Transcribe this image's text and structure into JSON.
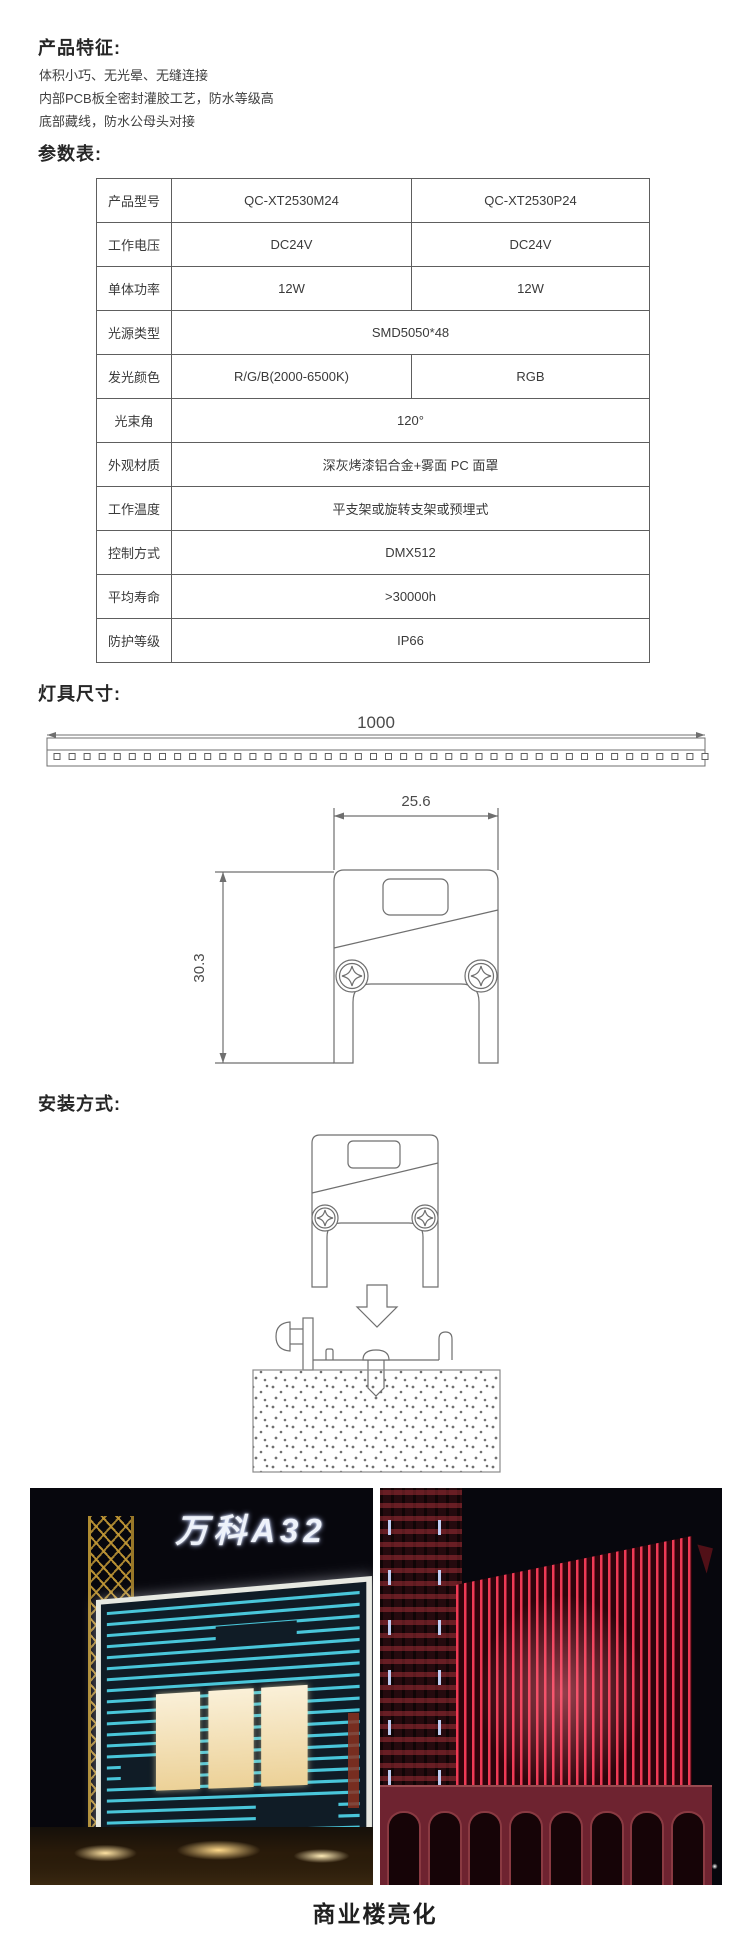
{
  "features": {
    "heading": "产品特征:",
    "lines": [
      "体积小巧、无光晕、无缝连接",
      "内部PCB板全密封灌胶工艺，防水等级高",
      "底部藏线，防水公母头对接"
    ]
  },
  "specs": {
    "heading": "参数表:",
    "rows": [
      {
        "label": "产品型号",
        "values": [
          "QC-XT2530M24",
          "QC-XT2530P24"
        ]
      },
      {
        "label": "工作电压",
        "values": [
          "DC24V",
          "DC24V"
        ]
      },
      {
        "label": "单体功率",
        "values": [
          "12W",
          "12W"
        ]
      },
      {
        "label": "光源类型",
        "values": [
          "SMD5050*48"
        ]
      },
      {
        "label": "发光颜色",
        "values": [
          "R/G/B(2000-6500K)",
          "RGB"
        ]
      },
      {
        "label": "光束角",
        "values": [
          "120°"
        ]
      },
      {
        "label": "外观材质",
        "values": [
          "深灰烤漆铝合金+雾面 PC 面罩"
        ]
      },
      {
        "label": "工作温度",
        "values": [
          "平支架或旋转支架或预埋式"
        ]
      },
      {
        "label": "控制方式",
        "values": [
          "DMX512"
        ]
      },
      {
        "label": "平均寿命",
        "values": [
          ">30000h"
        ]
      },
      {
        "label": "防护等级",
        "values": [
          "IP66"
        ]
      }
    ]
  },
  "dimensions": {
    "heading": "灯具尺寸:",
    "length": "1000",
    "width": "25.6",
    "height": "30.3"
  },
  "installation": {
    "heading": "安装方式:"
  },
  "gallery": {
    "sign_text": "万科A32",
    "caption": "商业楼亮化"
  },
  "colors": {
    "accent_cyan": "#49c6da",
    "accent_red": "#ef3a55",
    "drawing_line": "#6f6f6f"
  }
}
